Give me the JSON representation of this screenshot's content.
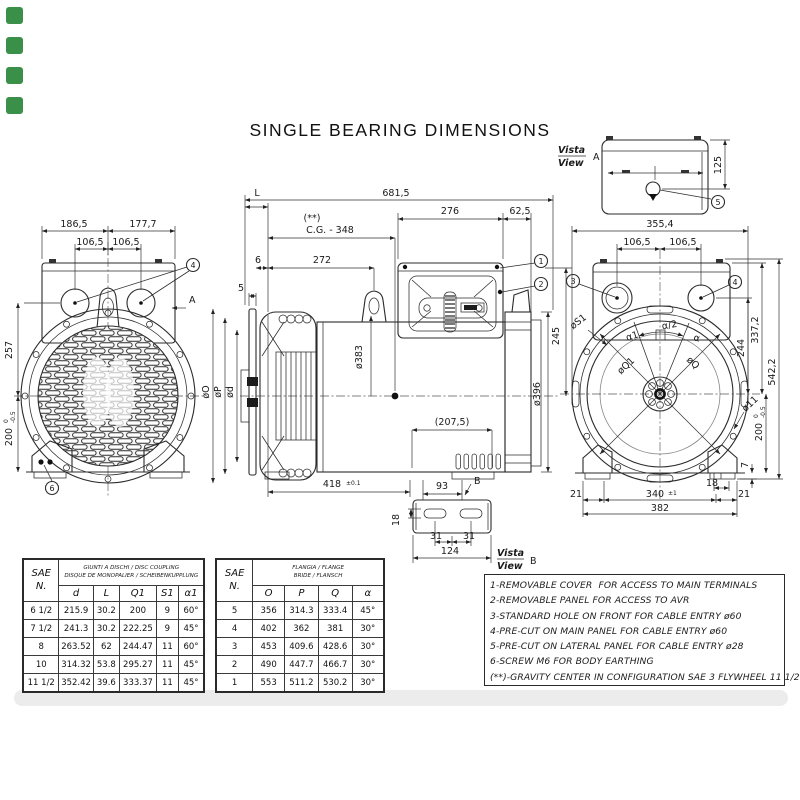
{
  "colors": {
    "marker_green": "#3a9048",
    "band_gray": "#ececec"
  },
  "title": "SINGLE BEARING DIMENSIONS",
  "front_view": {
    "dim_top_left": "186,5",
    "dim_top_right": "177,7",
    "dim_mid_left": "106,5",
    "dim_mid_right": "106,5",
    "dim_height_upper": "257",
    "dim_height_lower": "200",
    "tol_hi": "0",
    "tol_lo": "-0.5",
    "callout_holes": "4",
    "callout_earth": "6",
    "section_letter": "A"
  },
  "side_view": {
    "dim_L": "L",
    "dim_total": "681,5",
    "cg_mark": "(**)",
    "cg": "C.G. -  348",
    "dim_box": "276",
    "dim_rear": "62,5",
    "dim_6": "6",
    "dim_272": "272",
    "dim_5": "5",
    "dia_383": "ø383",
    "dia_396": "ø396",
    "dim_245": "245",
    "dim_2075": "(207,5)",
    "dim_418": "418",
    "dim_418_tol": "±0.1",
    "dim_93": "93",
    "detail_letter": "B",
    "callout_1": "1",
    "callout_2": "2",
    "dia_O": "øO",
    "dia_P": "øP",
    "dia_d": "ød"
  },
  "rear_view": {
    "dim_width": "355,4",
    "dim_hole_left": "106,5",
    "dim_hole_right": "106,5",
    "callout_3": "3",
    "callout_4": "4",
    "dia_S1": "øS1",
    "alpha1": "α1",
    "alpha_half": "α/2",
    "alpha": "α",
    "dia_Q1": "øQ1",
    "dia_Q": "øQ",
    "dim_244": "244",
    "dim_3372": "337,2",
    "dim_5422": "542,2",
    "dia_11": "ø11",
    "dim_200": "200",
    "tol_hi": "0",
    "tol_lo": "-0.5",
    "dim_7": "7",
    "dim_18": "18",
    "dim_21_left": "21",
    "dim_340": "340",
    "dim_340_tol": "±1",
    "dim_21_right": "21",
    "dim_382": "382"
  },
  "top_view": {
    "vista": "Vista",
    "view": "View",
    "letter": "A",
    "dim_125": "125",
    "callout_5": "5"
  },
  "bracket_view": {
    "vista": "Vista",
    "view": "View",
    "letter": "B",
    "dim_18": "18",
    "dim_31_left": "31",
    "dim_31_right": "31",
    "dim_124": "124"
  },
  "tables": {
    "coupling": {
      "corner_top": "SAE",
      "corner_bottom": "N.",
      "header_line1": "GIUNTI A DISCHI / DISC COUPLING",
      "header_line2": "DISQUE DE MONOPALIER / SCHEIBENKUPPLUNG",
      "columns": [
        "d",
        "L",
        "Q1",
        "S1",
        "α1"
      ],
      "rows": [
        [
          "6 1/2",
          "215.9",
          "30.2",
          "200",
          "9",
          "60°"
        ],
        [
          "7 1/2",
          "241.3",
          "30.2",
          "222.25",
          "9",
          "45°"
        ],
        [
          "8",
          "263.52",
          "62",
          "244.47",
          "11",
          "60°"
        ],
        [
          "10",
          "314.32",
          "53.8",
          "295.27",
          "11",
          "45°"
        ],
        [
          "11 1/2",
          "352.42",
          "39.6",
          "333.37",
          "11",
          "45°"
        ]
      ]
    },
    "flange": {
      "corner_top": "SAE",
      "corner_bottom": "N.",
      "header_line1": "FLANGIA / FLANGE",
      "header_line2": "BRIDE / FLANSCH",
      "columns": [
        "O",
        "P",
        "Q",
        "α"
      ],
      "rows": [
        [
          "5",
          "356",
          "314.3",
          "333.4",
          "45°"
        ],
        [
          "4",
          "402",
          "362",
          "381",
          "30°"
        ],
        [
          "3",
          "453",
          "409.6",
          "428.6",
          "30°"
        ],
        [
          "2",
          "490",
          "447.7",
          "466.7",
          "30°"
        ],
        [
          "1",
          "553",
          "511.2",
          "530.2",
          "30°"
        ]
      ]
    }
  },
  "notes": [
    "1-REMOVABLE COVER  FOR ACCESS TO MAIN TERMINALS",
    "2-REMOVABLE PANEL FOR ACCESS TO AVR",
    "3-STANDARD HOLE ON FRONT FOR CABLE ENTRY ø60",
    "4-PRE-CUT ON MAIN PANEL FOR CABLE ENTRY ø60",
    "5-PRE-CUT ON LATERAL PANEL FOR CABLE ENTRY ø28",
    "6-SCREW M6 FOR BODY EARTHING",
    "(**)-GRAVITY CENTER IN CONFIGURATION SAE 3 FLYWHEEL 11 1/2"
  ]
}
